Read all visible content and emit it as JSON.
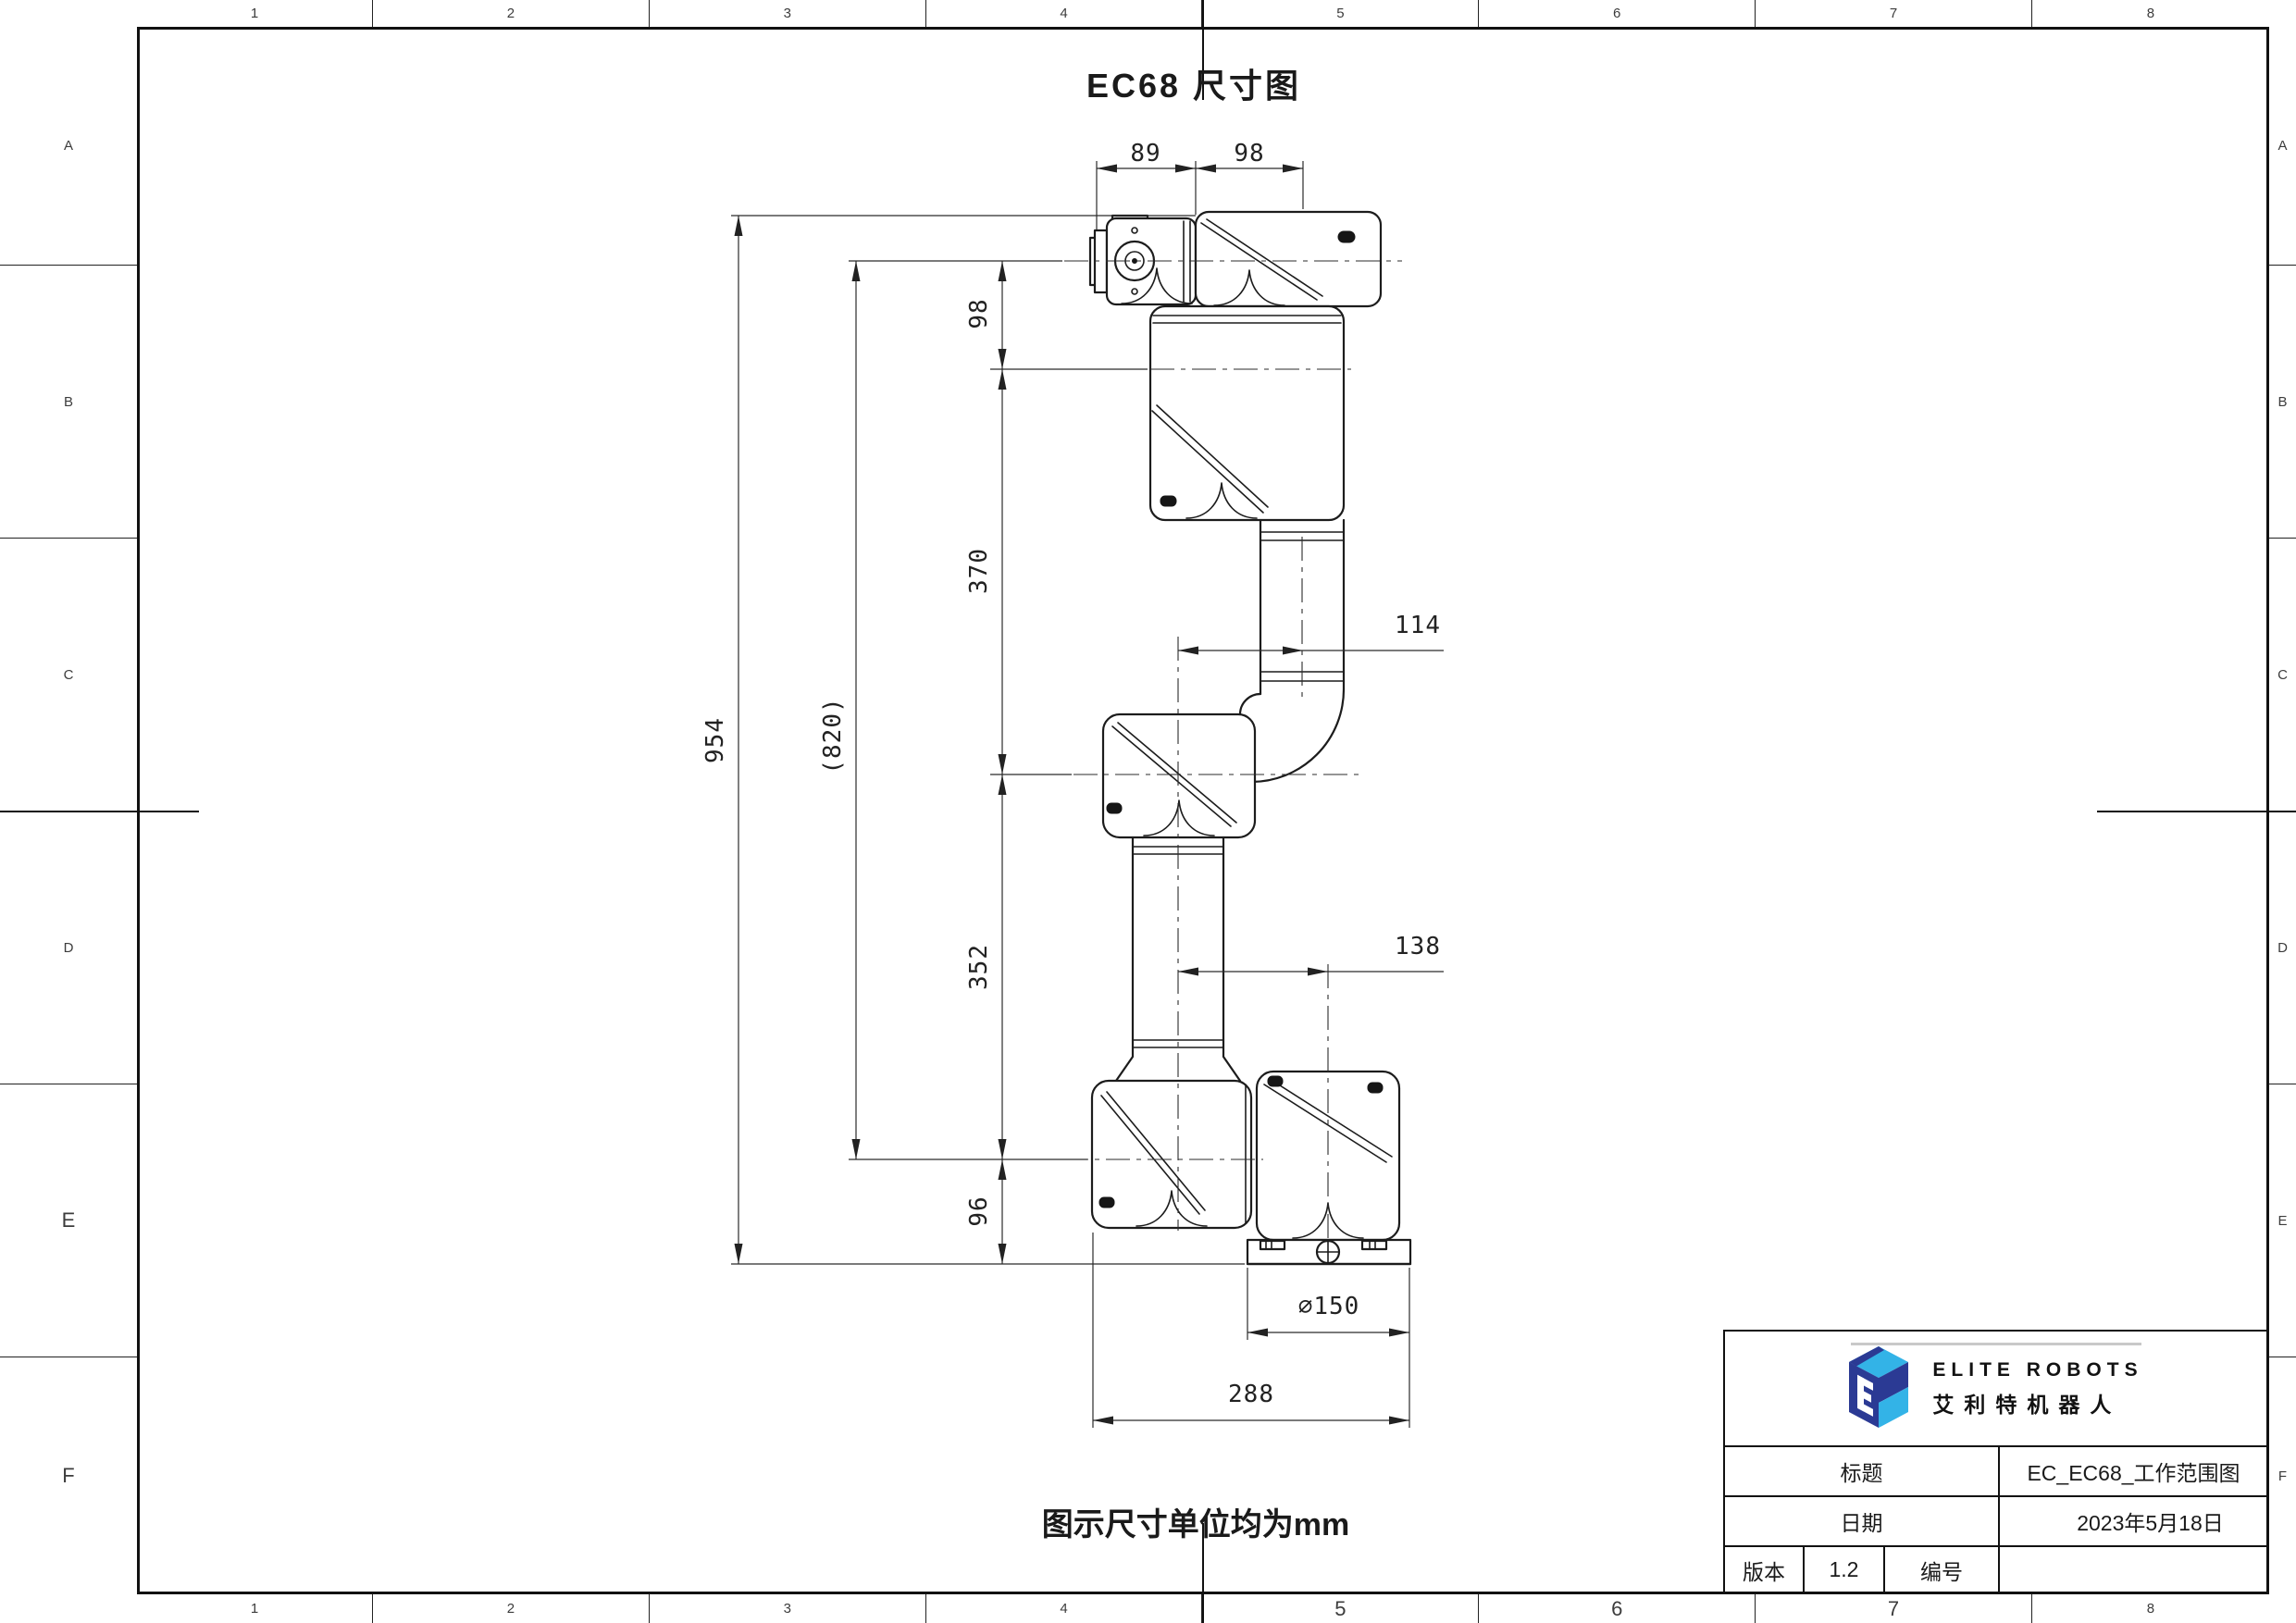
{
  "sheet": {
    "title": "EC68 尺寸图",
    "note": "图示尺寸单位均为mm"
  },
  "frame": {
    "top_labels": [
      "1",
      "2",
      "3",
      "4",
      "5",
      "6",
      "7",
      "8"
    ],
    "bottom_labels": [
      "1",
      "2",
      "3",
      "4",
      "5",
      "6",
      "7",
      "8"
    ],
    "left_labels": [
      "A",
      "B",
      "C",
      "D",
      "E",
      "F"
    ],
    "right_labels": [
      "A",
      "B",
      "C",
      "D",
      "E",
      "F"
    ],
    "large_bottom": [
      "5",
      "6",
      "7"
    ],
    "large_left": [
      "E",
      "F"
    ]
  },
  "dims": {
    "d89": "89",
    "d98_top": "98",
    "d98": "98",
    "d370": "370",
    "d954": "954",
    "d820": "(820)",
    "d352": "352",
    "d96": "96",
    "d114": "114",
    "d138": "138",
    "d150": "∅150",
    "d288": "288"
  },
  "titleblock": {
    "brand_en": "ELITE ROBOTS",
    "brand_cn": "艾利特机器人",
    "title_label": "标题",
    "title_value": "EC_EC68_工作范围图",
    "date_label": "日期",
    "date_value": "2023年5月18日",
    "version_label": "版本",
    "version_value": "1.2",
    "number_label": "编号",
    "number_value": "",
    "colors": {
      "navy": "#2b3a94",
      "blue": "#33b3e7",
      "rule_gray": "#c9c9c9"
    }
  }
}
